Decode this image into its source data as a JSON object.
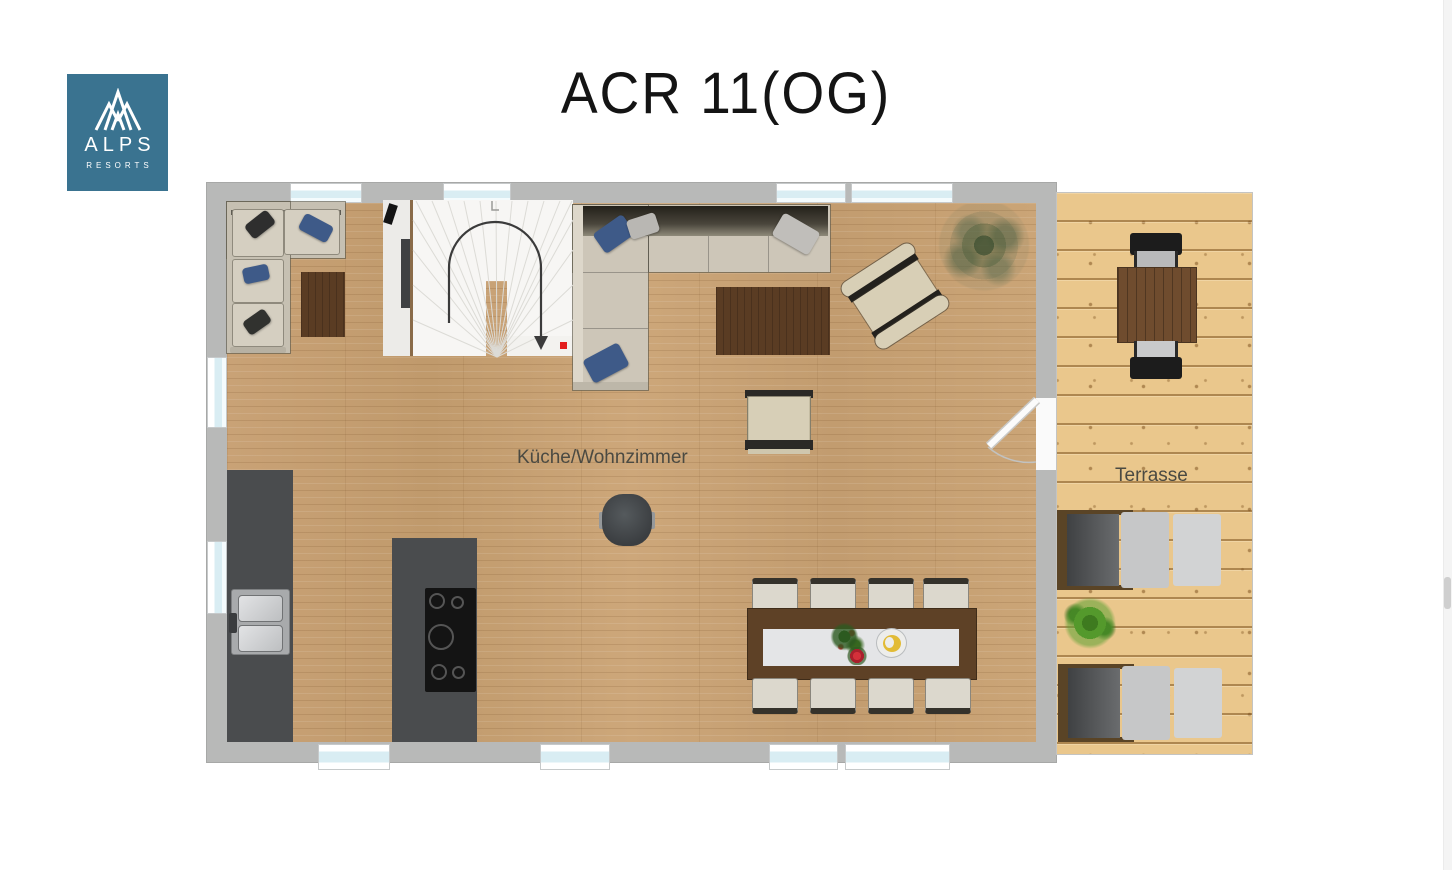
{
  "page": {
    "title": "ACR 11(OG)"
  },
  "logo": {
    "brand_top": "ALPS",
    "brand_bottom": "RESORTS",
    "bg_color": "#3A7390",
    "icon": "mountain-peaks-icon"
  },
  "floorplan": {
    "main_room_label": "Küche/Wohnzimmer",
    "terrace_label": "Terrasse"
  },
  "colors": {
    "wall": "#b8b9b8",
    "interior_floor": "#c8a276",
    "terrace_deck": "#eac78c",
    "window_glass": "#d9edf3",
    "rug": "#5a3c23",
    "kitchen_units": "#4a4c4e",
    "dining_table": "#5e4126",
    "sofa": "#d5cfc1",
    "accent_pillow_blue": "#3e5a88",
    "stair_arrow": "#3b3b3b",
    "stair_marker_red": "#e31e1e"
  }
}
